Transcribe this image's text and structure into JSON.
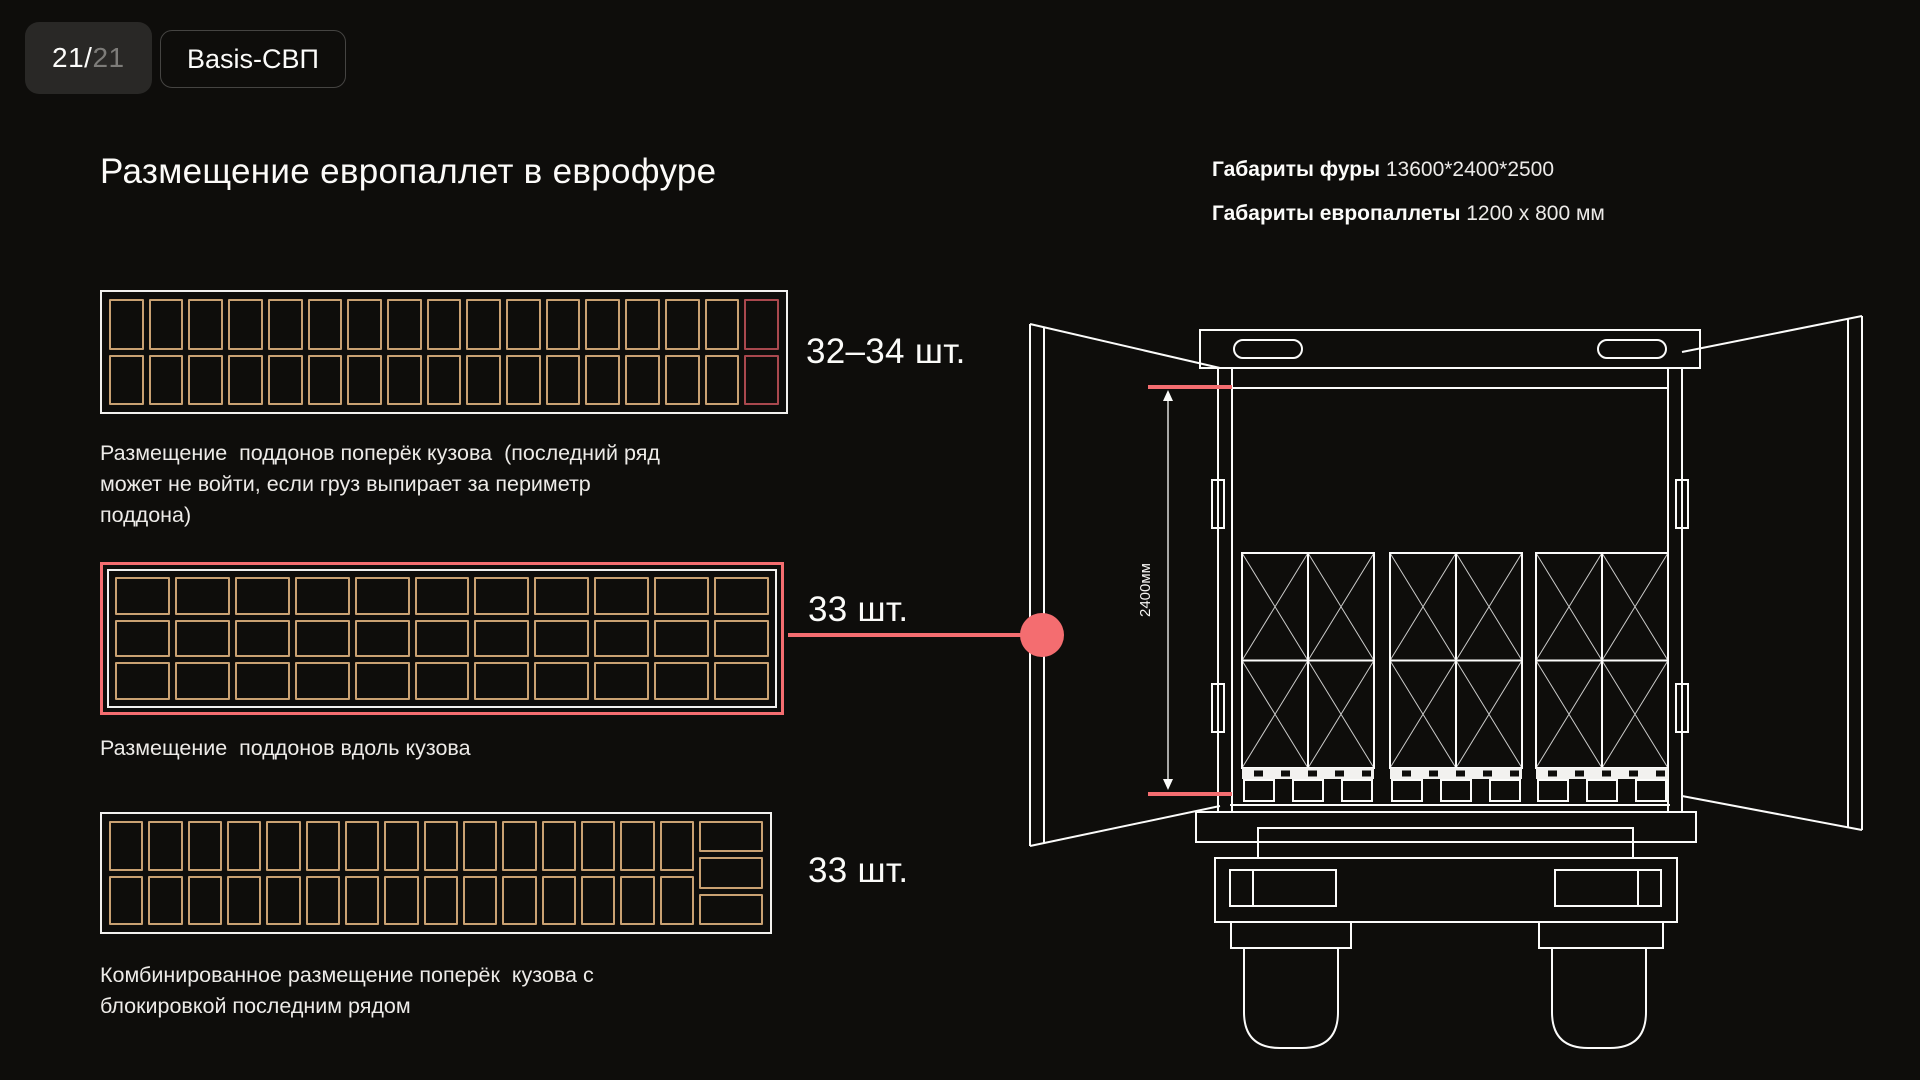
{
  "header": {
    "page_badge": {
      "current": "21/",
      "total": "21"
    },
    "brand_badge": "Basis-СВП",
    "title": "Размещение европаллет в еврофуре",
    "specs": [
      {
        "label": "Габариты фуры",
        "value": "13600*2400*2500"
      },
      {
        "label": "Габариты европаллеты",
        "value": "1200 x 800 мм"
      }
    ]
  },
  "layouts": [
    {
      "id": "transverse",
      "count_label": "32–34 шт.",
      "caption": "Размещение  поддонов поперёк кузова  (последний ряд может не войти, если груз выпирает за периметр поддона)",
      "grid": {
        "columns": 17,
        "rows": 2,
        "orientation": "portrait",
        "highlight_last_column": true
      }
    },
    {
      "id": "lengthwise",
      "count_label": "33 шт.",
      "caption": "Размещение  поддонов вдоль кузова",
      "grid": {
        "columns": 11,
        "rows": 3,
        "orientation": "landscape",
        "highlight_last_column": false
      }
    },
    {
      "id": "combined",
      "count_label": "33 шт.",
      "caption": "Комбинированное размещение поперёк  кузова с блокировкой последним рядом",
      "grid": {
        "columns": 15,
        "rows": 2,
        "orientation": "portrait",
        "last_col_landscape_rows": 3
      }
    }
  ],
  "truck": {
    "dimension_label": "2400мм",
    "pallet_stacks": 3
  },
  "colors": {
    "accent_pink": "#f46d70",
    "pallet_gold": "#c9a172",
    "pallet_red": "#a9484e",
    "frame_white": "#f2f1ef",
    "bg": "#0e0d0b"
  }
}
